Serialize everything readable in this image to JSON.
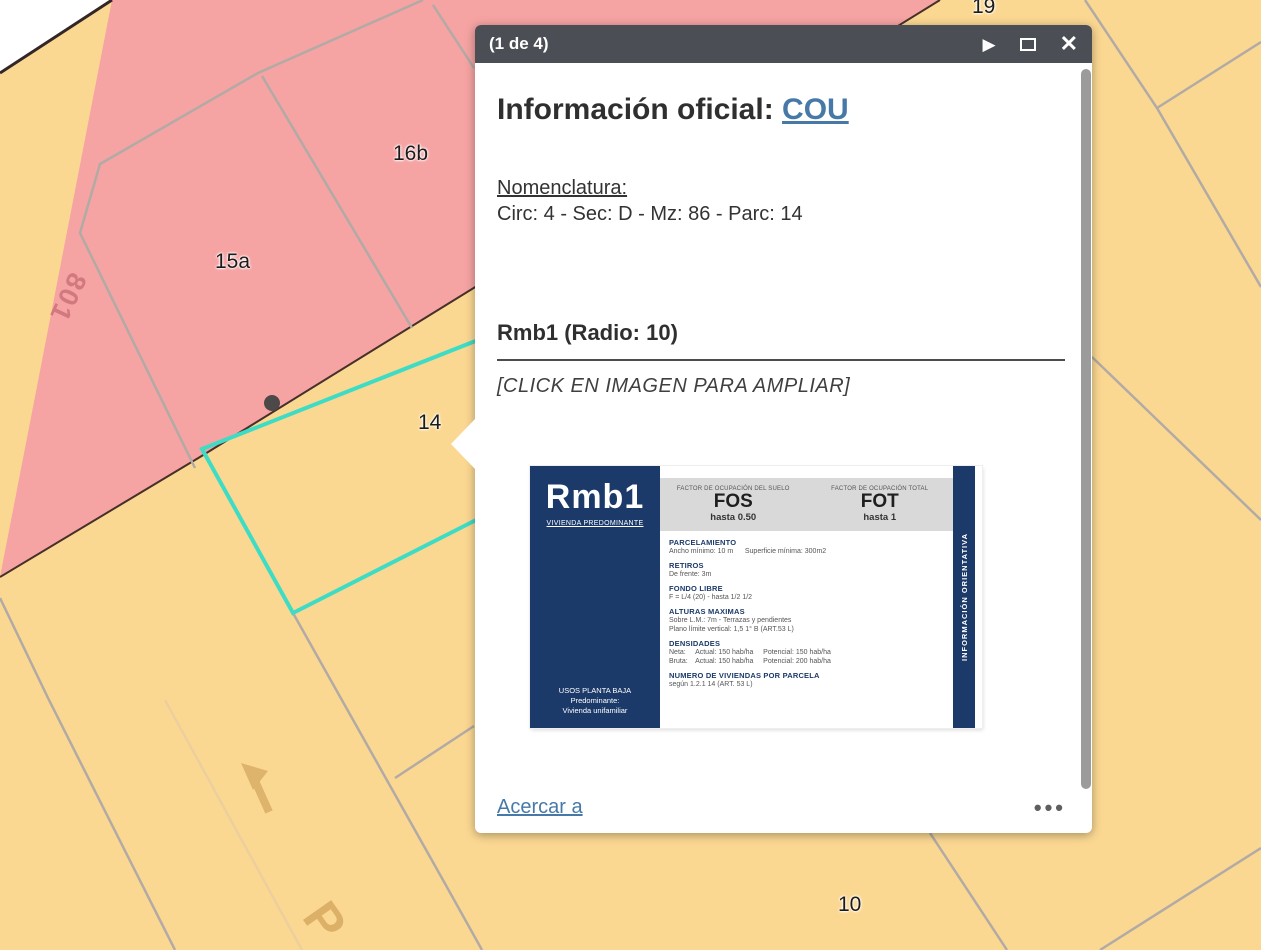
{
  "map": {
    "colors": {
      "parcel_pink": "#f6a3a3",
      "parcel_yellow": "#fbd892",
      "parcel_line_gray": "#b2aaa4",
      "selection_teal": "#3edcc5",
      "street_edge_dark": "#46302a"
    },
    "labels": {
      "p801": "801",
      "p15a": "15a",
      "p16b": "16b",
      "p14": "14",
      "p19": "19",
      "p10": "10",
      "street_letter": "P"
    }
  },
  "popup": {
    "header": {
      "pager": "(1 de 4)",
      "next_glyph": "▶",
      "close_glyph": "✕"
    },
    "title": {
      "prefix": "Información oficial: ",
      "link": "COU"
    },
    "nomenclature": {
      "label": "Nomenclatura:",
      "value": "Circ: 4 - Sec: D - Mz: 86 - Parc: 14"
    },
    "zone_title": "Rmb1 (Radio: 10)",
    "click_note": "[CLICK EN IMAGEN PARA AMPLIAR]",
    "card": {
      "code": "Rmb1",
      "code_subtitle": "VIVIENDA PREDOMINANTE",
      "panel_footer_1": "USOS PLANTA BAJA",
      "panel_footer_2": "Predominante:",
      "panel_footer_3": "Vivienda unifamiliar",
      "fos_caption": "FACTOR DE OCUPACIÓN DEL SUELO",
      "fos_label": "FOS",
      "fos_value": "hasta 0.50",
      "fot_caption": "FACTOR DE OCUPACIÓN TOTAL",
      "fot_label": "FOT",
      "fot_value": "hasta 1",
      "side_label": "INFORMACIÓN ORIENTATIVA",
      "sections": [
        {
          "heading": "PARCELAMIENTO",
          "lines": [
            "Ancho mínimo: 10 m      Superficie mínima: 300m2"
          ]
        },
        {
          "heading": "RETIROS",
          "lines": [
            "De frente: 3m"
          ]
        },
        {
          "heading": "FONDO LIBRE",
          "lines": [
            "F = L/4 (20) - hasta 1/2 1/2"
          ]
        },
        {
          "heading": "ALTURAS MAXIMAS",
          "lines": [
            "Sobre L.M.: 7m - Terrazas y pendientes",
            "Plano límite vertical: 1,5 1° B (ART.53 L)"
          ]
        },
        {
          "heading": "DENSIDADES",
          "lines": [
            "Neta:     Actual: 150 hab/ha     Potencial: 150 hab/ha",
            "Bruta:    Actual: 150 hab/ha     Potencial: 200 hab/ha"
          ]
        },
        {
          "heading": "NUMERO DE VIVIENDAS POR PARCELA",
          "lines": [
            "según 1.2.1 14 (ART. 53 L)"
          ]
        }
      ]
    },
    "footer": {
      "zoom_link": "Acercar a",
      "more_glyph": "•••"
    }
  }
}
